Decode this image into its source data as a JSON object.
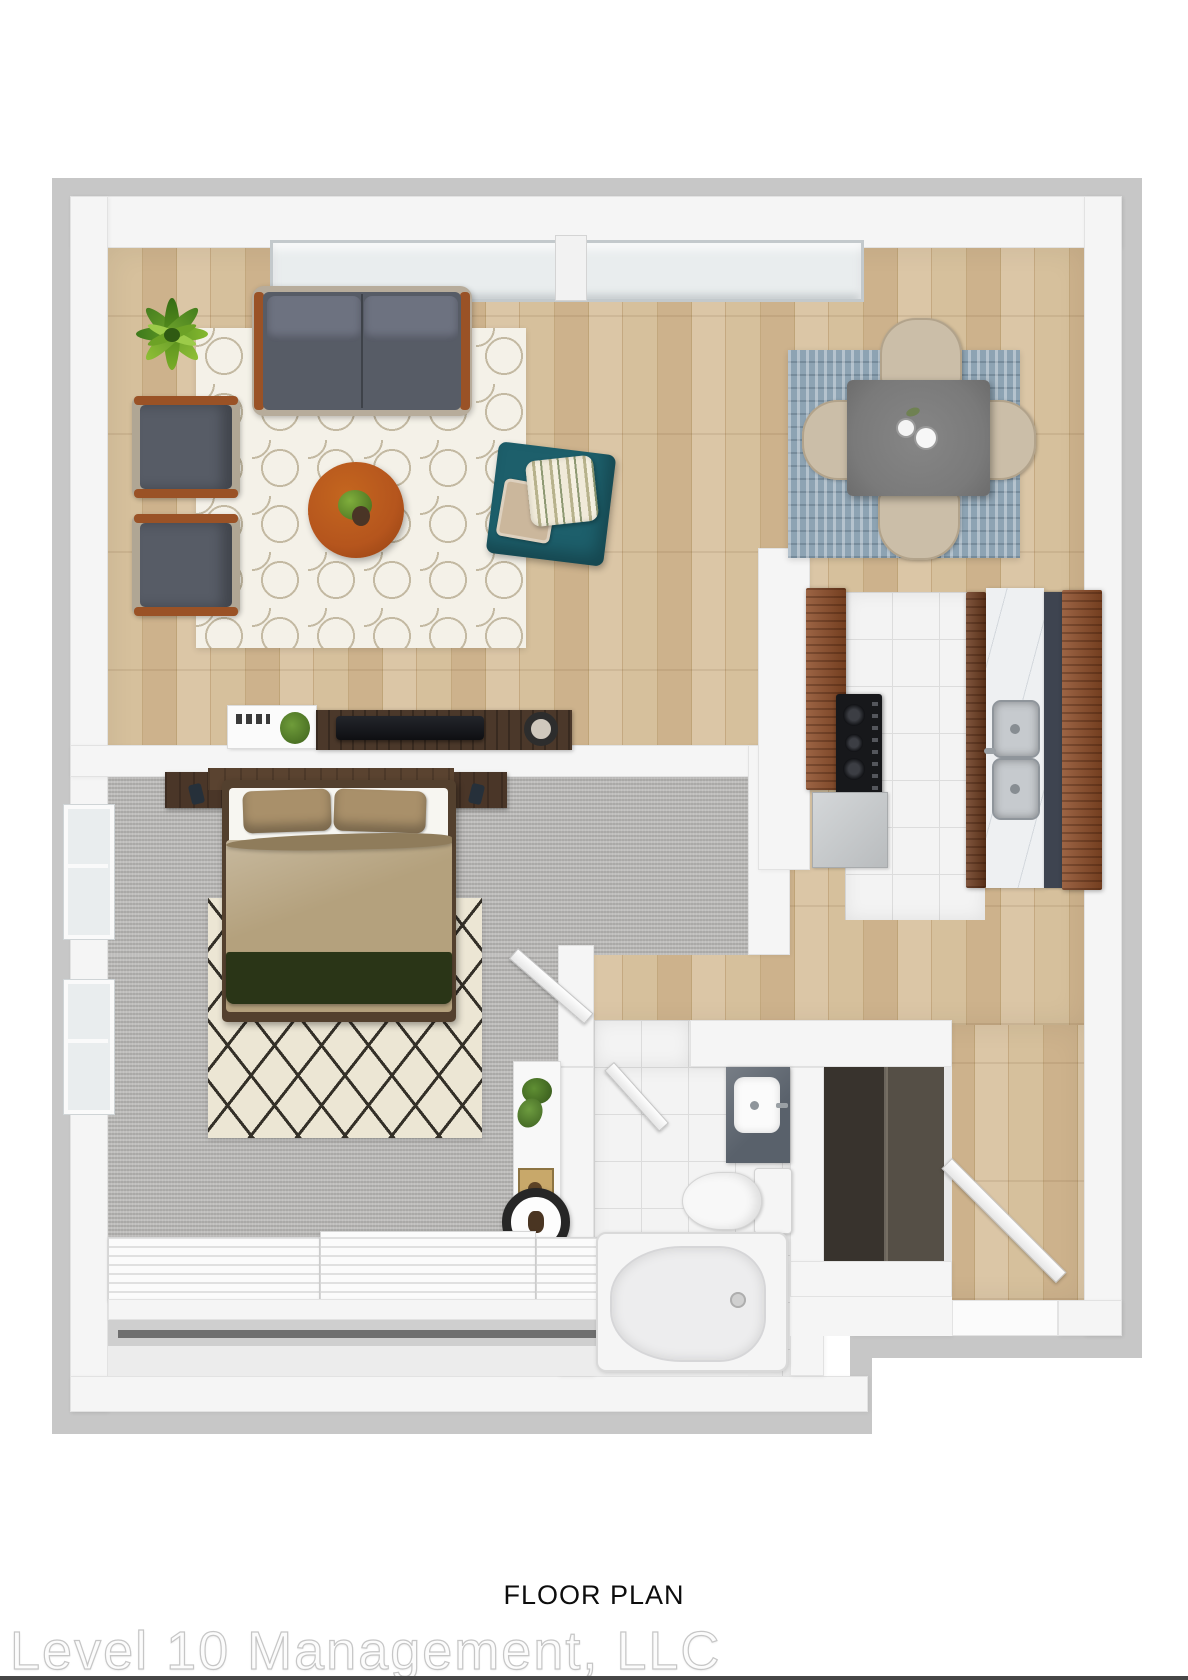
{
  "footer": {
    "caption": "FLOOR PLAN",
    "watermark": "Level 10 Management, LLC"
  },
  "palette": {
    "wood": "#cdb28a",
    "wall": "#f5f5f5",
    "wallshadow": "#c7c7c7",
    "carpet": "#b3b2b0",
    "tile": "#f3f3f3",
    "rugbase": "#f4f1e8",
    "rugline": "#c3b9a2",
    "diamondbase": "#ece6d4",
    "diamondline": "#343028",
    "diningrug": "#8da3b3",
    "diningchair": "#cbbea8",
    "tablegray": "#7a7a7a",
    "sofa": "#575c66",
    "cushion": "#6d7280",
    "framewood": "#9a5226",
    "coffeetable": "#b5551d",
    "pouf": "#1d5f6b",
    "duvet": "#b4a17d",
    "pillowtan": "#a9906a",
    "throwgreen": "#2a3517",
    "headboard": "#5a4330",
    "bedframe": "#53402e",
    "cabinetwood": "#8c4b26",
    "marble": "#eef0f2",
    "vanity": "#59616b",
    "closetdark": "#413b35",
    "glass": "#e9edee",
    "plantgreen": "#5d9324"
  }
}
